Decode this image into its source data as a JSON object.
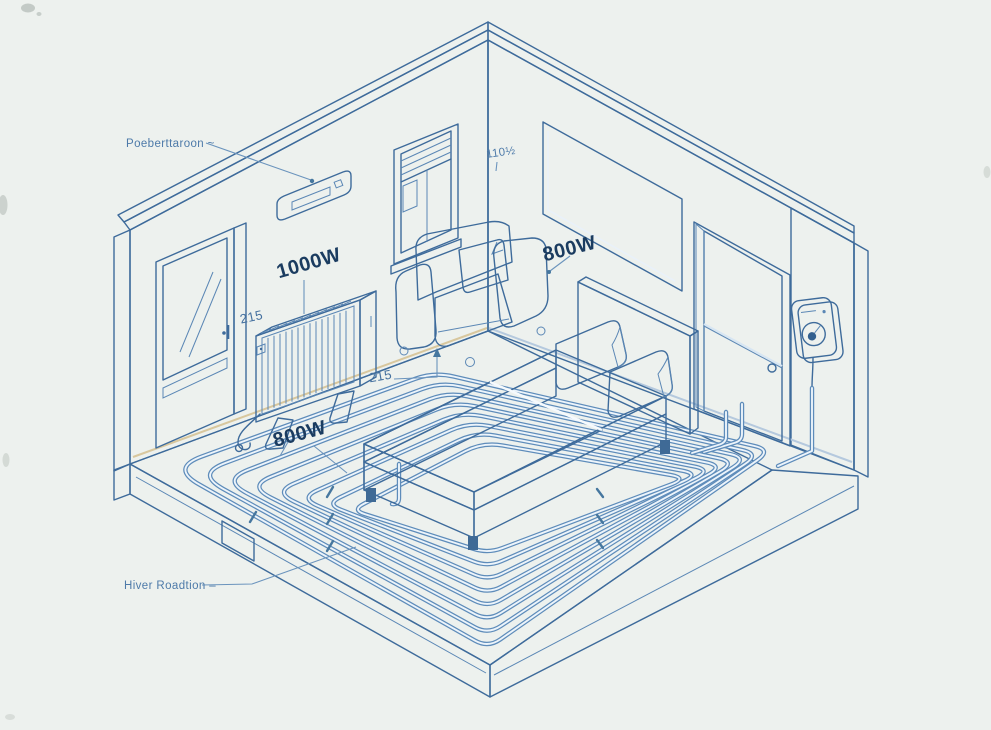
{
  "labels": {
    "heater_location": "Poeberttaroon ~",
    "radiator_power": "1000W",
    "radiator_height": "215",
    "window_dim": "110½",
    "panel_power": "800W",
    "bed_clearance": "215",
    "floor_power": "800W",
    "heater_position": "Hiver Roadtion –"
  },
  "colors": {
    "background": "#edf1ee",
    "outline": "#3e6b9b",
    "left_wall": "#fcf5e2",
    "right_wall": "#cfe0f0",
    "floor": "#fbf4e1",
    "pipe": "#5e8cba",
    "bed_blue": "#6d99c9",
    "text_dark": "#1b3c60",
    "text_light": "#4d7aa9"
  }
}
